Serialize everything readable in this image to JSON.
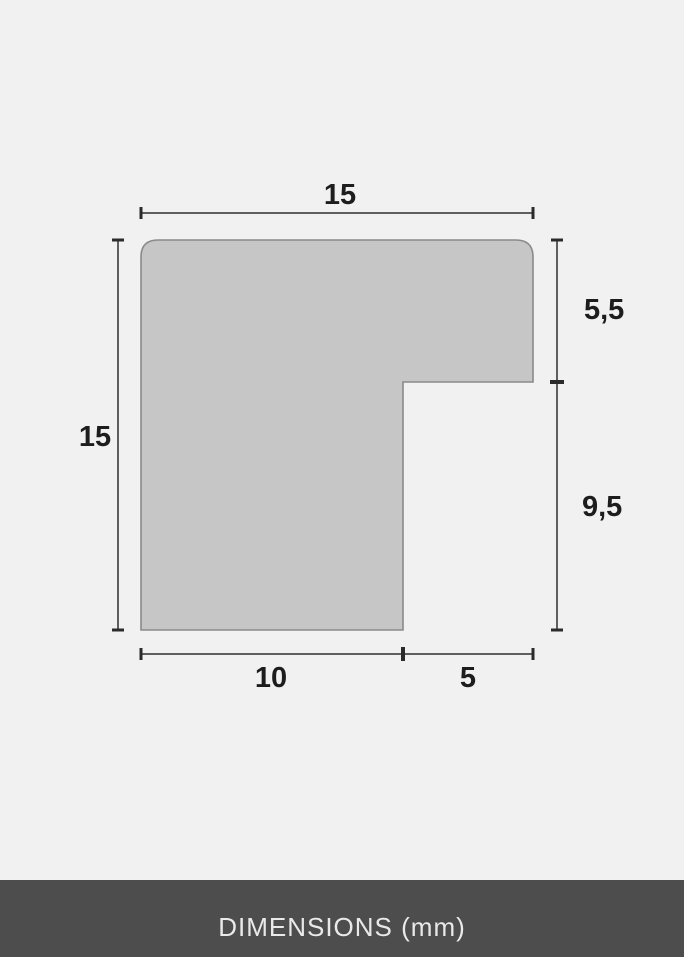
{
  "diagram": {
    "type": "technical-profile-cross-section",
    "unit": "mm",
    "labels": {
      "top_width": "15",
      "left_height": "15",
      "right_upper": "5,5",
      "right_lower": "9,5",
      "bottom_left": "10",
      "bottom_right": "5"
    },
    "measurements": {
      "total_width_mm": 15,
      "total_height_mm": 15,
      "right_upper_mm": 5.5,
      "right_lower_mm": 9.5,
      "bottom_left_mm": 10,
      "bottom_right_mm": 5
    },
    "colors": {
      "background": "#f1f1f1",
      "shape_fill": "#c6c6c6",
      "shape_stroke": "#8a8a8a",
      "dimension_line": "#5f5f5f",
      "tick": "#2b2b2b",
      "label_text": "#1d1d1d",
      "footer_bg": "#4d4d4d",
      "footer_text": "#e9e9e9"
    },
    "footer": {
      "label": "DIMENSIONS (mm)"
    }
  }
}
